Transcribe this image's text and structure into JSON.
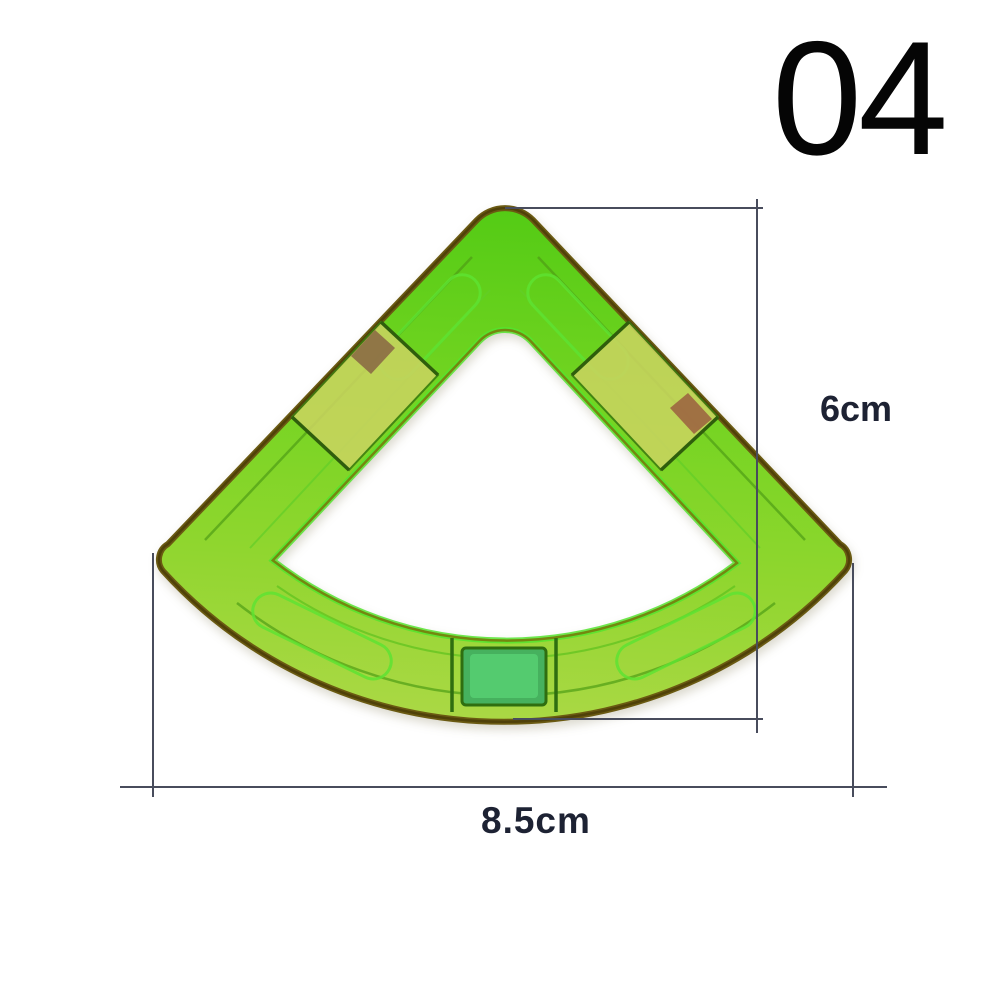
{
  "image": {
    "subject": "green translucent sector (quarter-circle fan) magnetic building tile viewed from above on white background",
    "background_color": "#ffffff"
  },
  "item_number": "04",
  "dimensions": {
    "height": {
      "label": "6cm"
    },
    "width": {
      "label": "8.5cm"
    }
  },
  "colors": {
    "tile_green_bright": "#5ccd1c",
    "tile_green_mid": "#84d42a",
    "tile_yellow_green": "#aad840",
    "rim_olive_dark": "#5c4c0e",
    "inner_glow_green": "#55e42e",
    "magnet_pocket_yellow": "#c9d45f",
    "magnet_brown": "#8b6b45",
    "bottom_pocket_teal": "#46b15e",
    "dimension_line": "#484c5c",
    "dimension_label_text": "#1d2233",
    "item_number_text": "#050505"
  }
}
